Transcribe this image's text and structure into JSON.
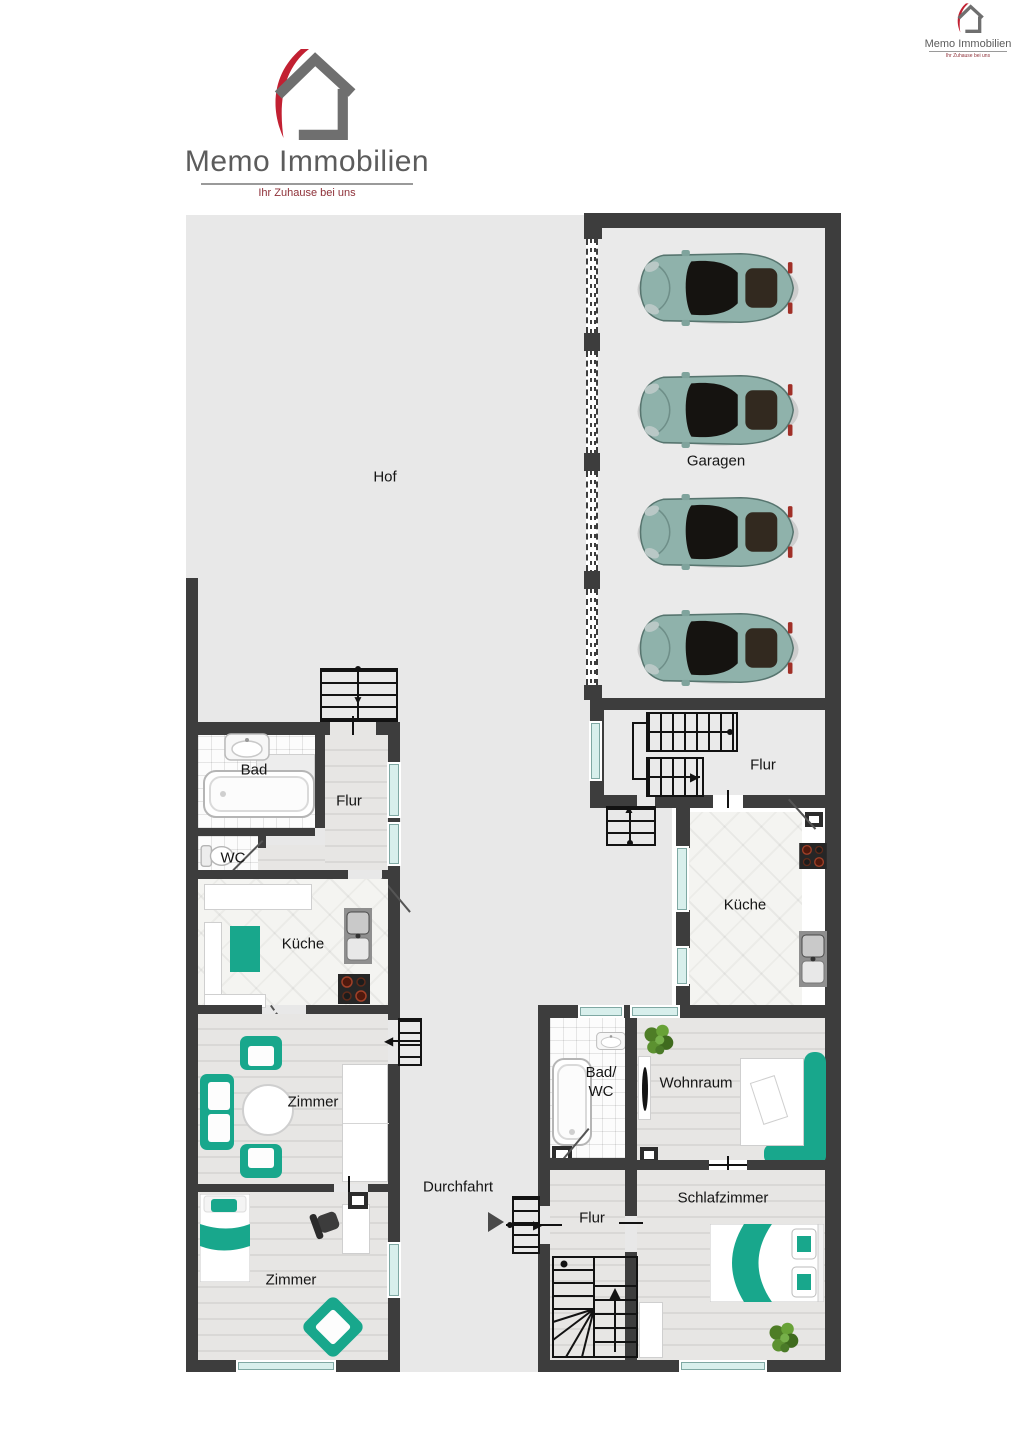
{
  "brand": {
    "name": "Memo Immobilien",
    "tagline": "Ihr Zuhause bei uns"
  },
  "rooms": {
    "hof": "Hof",
    "garagen": "Garagen",
    "flur_og": "Flur",
    "kueche_og": "Küche",
    "bad_wc_l1": "Bad/",
    "bad_wc_l2": "WC",
    "wohnraum": "Wohnraum",
    "schlafzimmer": "Schlafzimmer",
    "flur_eg_rechts": "Flur",
    "durchfahrt": "Durchfahrt",
    "bad": "Bad",
    "wc": "WC",
    "flur_links": "Flur",
    "kueche_links": "Küche",
    "zimmer_oben": "Zimmer",
    "zimmer_unten": "Zimmer"
  },
  "garage": {
    "car_count": 4
  },
  "colors": {
    "wall": "#3d3d3d",
    "courtyard": "#e8e8e8",
    "accent_teal": "#18a78c",
    "car_body": "#8fb2ab",
    "logo_red": "#c22032",
    "logo_gray": "#5c5c5c",
    "window": "#d8efec"
  }
}
